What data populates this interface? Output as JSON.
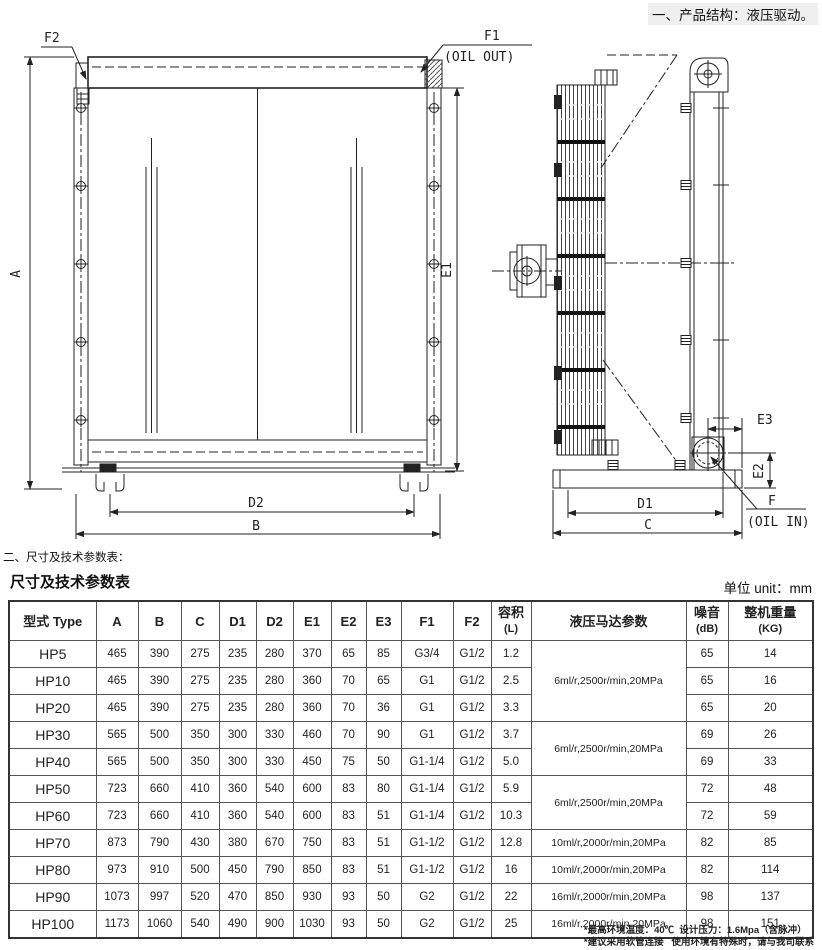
{
  "page": {
    "top_note": "一、产品结构：液压驱动。",
    "section_heading": "二、尺寸及技术参数表：",
    "footnote_line1": "*最高环境温度：40℃  设计压力：1.6Mpa（含脉冲）",
    "footnote_line2": "*建议采用软管连接   使用环境有特殊时，请与我司联系"
  },
  "drawing": {
    "front": {
      "f2": "F2",
      "f1": "F1",
      "oil_out": "(OIL OUT)",
      "dim_a": "A",
      "dim_e1": "E1",
      "dim_d2": "D2",
      "dim_b": "B"
    },
    "side": {
      "dim_e3": "E3",
      "dim_e2": "E2",
      "f": "F",
      "oil_in": "(OIL IN)",
      "dim_d1": "D1",
      "dim_c": "C"
    }
  },
  "table": {
    "title": "尺寸及技术参数表",
    "unit": "单位 unit：mm",
    "headers": [
      {
        "t": "型式 Type"
      },
      {
        "t": "A"
      },
      {
        "t": "B"
      },
      {
        "t": "C"
      },
      {
        "t": "D1"
      },
      {
        "t": "D2"
      },
      {
        "t": "E1"
      },
      {
        "t": "E2"
      },
      {
        "t": "E3"
      },
      {
        "t": "F1"
      },
      {
        "t": "F2"
      },
      {
        "t": "容积",
        "s": "(L)"
      },
      {
        "t": "液压马达参数"
      },
      {
        "t": "噪音",
        "s": "(dB)"
      },
      {
        "t": "整机重量",
        "s": "(KG)"
      }
    ],
    "rows": [
      {
        "model": "HP5",
        "values": [
          "465",
          "390",
          "275",
          "235",
          "280",
          "370",
          "65",
          "85",
          "G3/4",
          "G1/2",
          "1.2"
        ],
        "motor": {
          "text": "6ml/r,2500r/min,20MPa",
          "span": 3
        },
        "noise": "65",
        "weight": "14"
      },
      {
        "model": "HP10",
        "values": [
          "465",
          "390",
          "275",
          "235",
          "280",
          "360",
          "70",
          "65",
          "G1",
          "G1/2",
          "2.5"
        ],
        "noise": "65",
        "weight": "16"
      },
      {
        "model": "HP20",
        "values": [
          "465",
          "390",
          "275",
          "235",
          "280",
          "360",
          "70",
          "36",
          "G1",
          "G1/2",
          "3.3"
        ],
        "noise": "65",
        "weight": "20"
      },
      {
        "model": "HP30",
        "values": [
          "565",
          "500",
          "350",
          "300",
          "330",
          "460",
          "70",
          "90",
          "G1",
          "G1/2",
          "3.7"
        ],
        "motor": {
          "text": "6ml/r,2500r/min,20MPa",
          "span": 2
        },
        "noise": "69",
        "weight": "26"
      },
      {
        "model": "HP40",
        "values": [
          "565",
          "500",
          "350",
          "300",
          "330",
          "450",
          "75",
          "50",
          "G1-1/4",
          "G1/2",
          "5.0"
        ],
        "noise": "69",
        "weight": "33"
      },
      {
        "model": "HP50",
        "values": [
          "723",
          "660",
          "410",
          "360",
          "540",
          "600",
          "83",
          "80",
          "G1-1/4",
          "G1/2",
          "5.9"
        ],
        "motor": {
          "text": "6ml/r,2500r/min,20MPa",
          "span": 2
        },
        "noise": "72",
        "weight": "48"
      },
      {
        "model": "HP60",
        "values": [
          "723",
          "660",
          "410",
          "360",
          "540",
          "600",
          "83",
          "51",
          "G1-1/4",
          "G1/2",
          "10.3"
        ],
        "noise": "72",
        "weight": "59"
      },
      {
        "model": "HP70",
        "values": [
          "873",
          "790",
          "430",
          "380",
          "670",
          "750",
          "83",
          "51",
          "G1-1/2",
          "G1/2",
          "12.8"
        ],
        "motor": {
          "text": "10ml/r,2000r/min,20MPa",
          "span": 1
        },
        "noise": "82",
        "weight": "85"
      },
      {
        "model": "HP80",
        "values": [
          "973",
          "910",
          "500",
          "450",
          "790",
          "850",
          "83",
          "51",
          "G1-1/2",
          "G1/2",
          "16"
        ],
        "motor": {
          "text": "10ml/r,2000r/min,20MPa",
          "span": 1
        },
        "noise": "82",
        "weight": "114"
      },
      {
        "model": "HP90",
        "values": [
          "1073",
          "997",
          "520",
          "470",
          "850",
          "930",
          "93",
          "50",
          "G2",
          "G1/2",
          "22"
        ],
        "motor": {
          "text": "16ml/r,2000r/min,20MPa",
          "span": 1
        },
        "noise": "98",
        "weight": "137"
      },
      {
        "model": "HP100",
        "values": [
          "1173",
          "1060",
          "540",
          "490",
          "900",
          "1030",
          "93",
          "50",
          "G2",
          "G1/2",
          "25"
        ],
        "motor": {
          "text": "16ml/r,2000r/min,20MPa",
          "span": 1
        },
        "noise": "98",
        "weight": "151"
      }
    ]
  }
}
